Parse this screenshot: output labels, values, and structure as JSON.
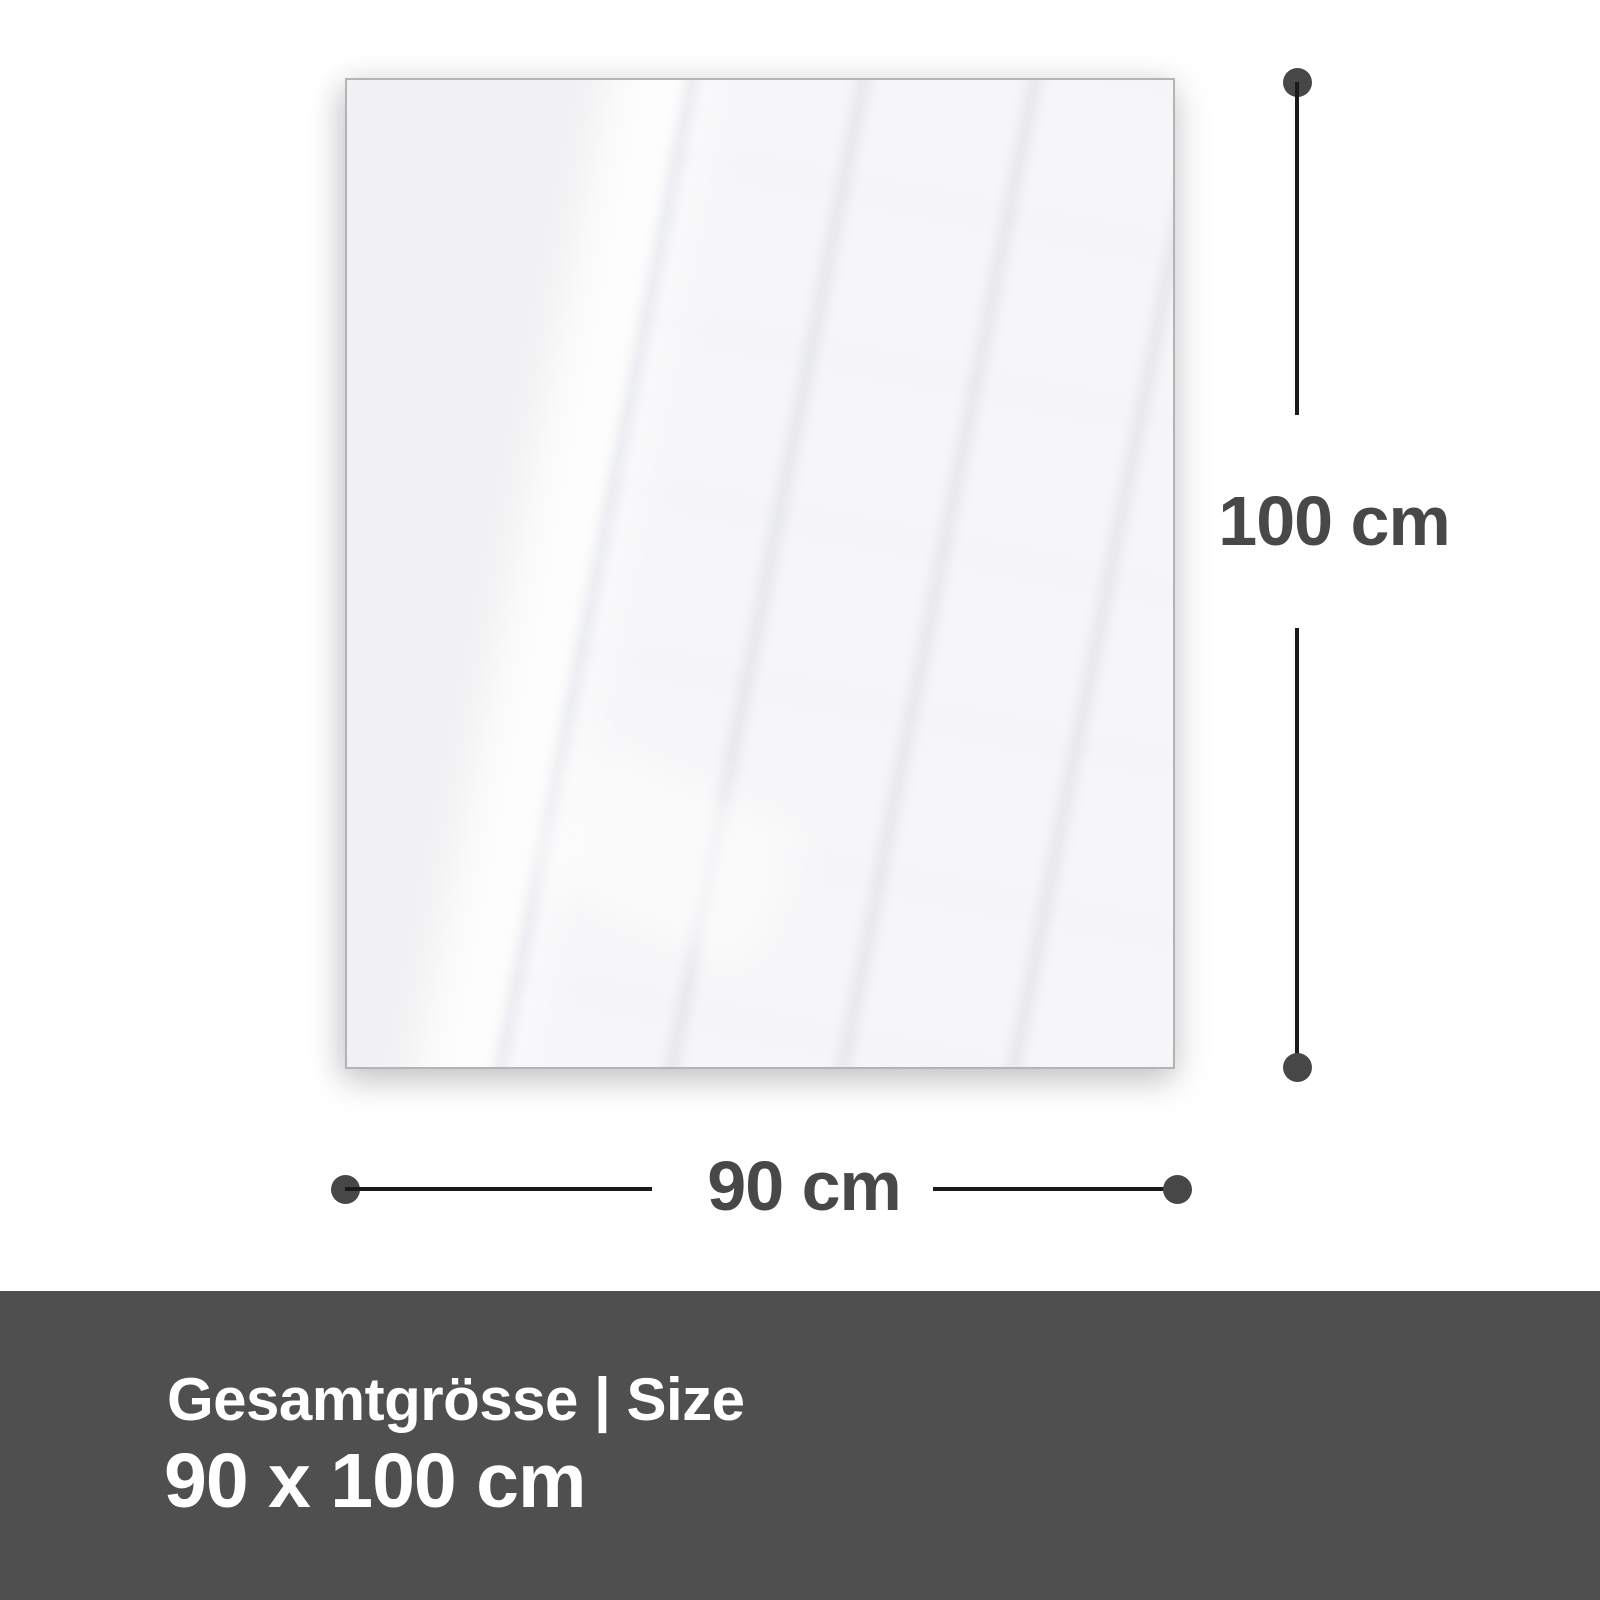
{
  "diagram": {
    "height_label": "100 cm",
    "width_label": "90 cm"
  },
  "banner": {
    "title": "Gesamtgrösse | Size",
    "size_value": "90 x 100 cm"
  },
  "colors": {
    "background": "#ffffff",
    "panel_fill": "#f1f1f3",
    "panel_border": "#b3b3b8",
    "dimension_line": "#1a1a1a",
    "dimension_dot": "#474747",
    "dimension_text": "#484848",
    "banner_background": "#4f4f4f",
    "banner_text": "#ffffff"
  }
}
